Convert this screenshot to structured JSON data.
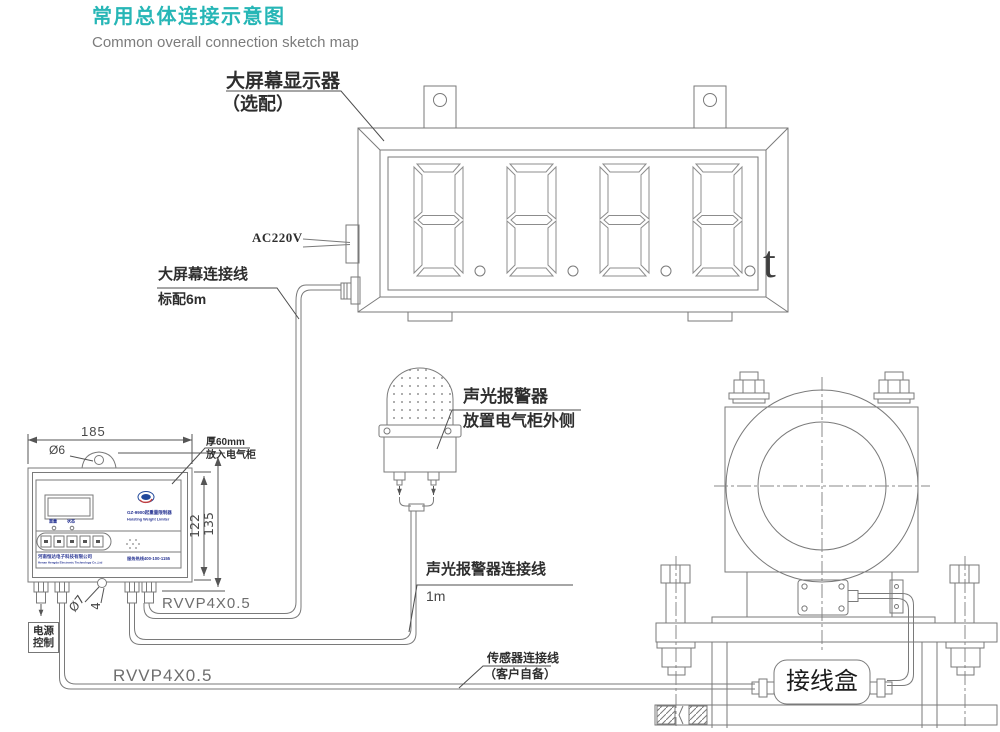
{
  "title": {
    "zh": "常用总体连接示意图",
    "en": "Common overall connection sketch map"
  },
  "ann": {
    "display": {
      "name": "大屏幕显示器",
      "option": "（选配）"
    },
    "power_in": "AC220V",
    "display_cable": {
      "name": "大屏幕连接线",
      "spec": "标配6m"
    },
    "display_cable_spec": "RVVP4X0.5",
    "alarm": {
      "name": "声光报警器",
      "note": "放置电气柜外侧"
    },
    "controller": {
      "thickness": "厚60mm",
      "note": "放入电气柜"
    },
    "alarm_cable": {
      "name": "声光报警器连接线",
      "spec": "1m"
    },
    "sensor_cable": {
      "name": "传感器连接线",
      "note": "（客户自备）",
      "spec": "RVVP4X0.5"
    },
    "junction_box": "接线盒",
    "power_control": {
      "line1": "电源",
      "line2": "控制"
    },
    "display_unit": "t"
  },
  "dims": {
    "width": "185",
    "mount_hole": "Ø6",
    "panel_height": "122",
    "total_height": "135",
    "bottom_hole": "Ø7",
    "bottom_hole_count": "4"
  },
  "panel": {
    "indicator1": "重量",
    "indicator2": "状态",
    "model_cn": "GZ-9900起重量限制器",
    "model_en": "Hoisting Weight Limiter",
    "company_cn": "河南恒达电子科技有限公司",
    "company_en": "Henan Hengda Electronic Technology Co.,Ltd",
    "service": "服务热线400-100-1155"
  },
  "colors": {
    "accent": "#26b6b6",
    "line": "#7a7a7a",
    "label": "#2e2e2e",
    "logo_blue": "#20489b",
    "logo_red": "#c43f3f",
    "panel_text": "#283593"
  }
}
